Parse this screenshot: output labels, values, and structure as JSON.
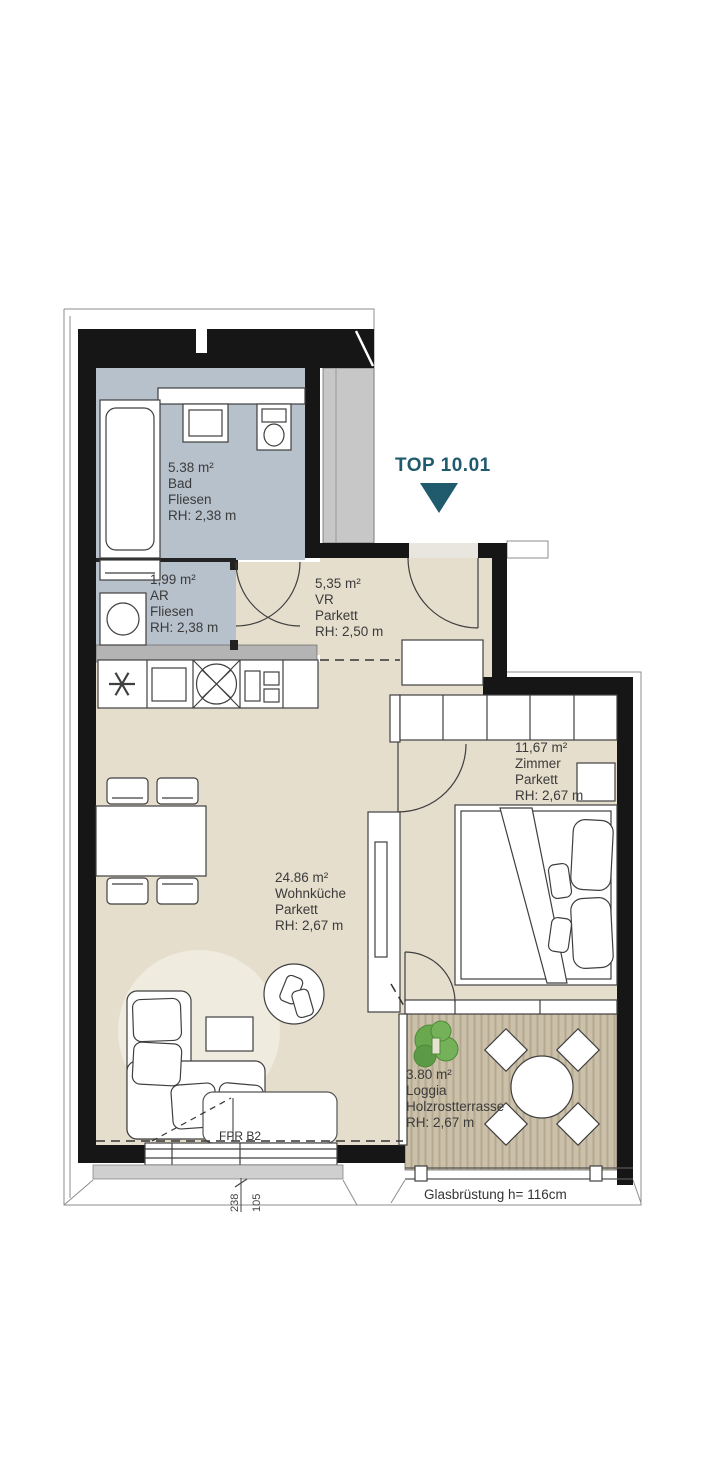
{
  "unit": {
    "label": "TOP 10.01"
  },
  "rooms": [
    {
      "id": "bad",
      "area": "5.38 m²",
      "name": "Bad",
      "floor": "Fliesen",
      "rh": "RH: 2,38 m"
    },
    {
      "id": "ar",
      "area": "1,99 m²",
      "name": "AR",
      "floor": "Fliesen",
      "rh": "RH: 2,38 m"
    },
    {
      "id": "vr",
      "area": "5,35 m²",
      "name": "VR",
      "floor": "Parkett",
      "rh": "RH: 2,50 m"
    },
    {
      "id": "wohnkueche",
      "area": "24.86 m²",
      "name": "Wohnküche",
      "floor": "Parkett",
      "rh": "RH: 2,67 m"
    },
    {
      "id": "zimmer",
      "area": "11,67 m²",
      "name": "Zimmer",
      "floor": "Parkett",
      "rh": "RH: 2,67 m"
    },
    {
      "id": "loggia",
      "area": "3.80 m²",
      "name": "Loggia",
      "floor": "Holzrostterrasse",
      "rh": "RH: 2,67 m"
    }
  ],
  "annotations": {
    "window_note": "FPR B2",
    "balustrade_note": "Glasbrüstung h= 116cm",
    "dimensions": [
      "238",
      "105"
    ]
  },
  "colors": {
    "accent_teal": "#1f5a6d",
    "wall_black": "#161616",
    "wet_room_floor": "#b7c1cc",
    "living_floor": "#e6decd",
    "deck_floor": "#cbc0a9",
    "shaft_gray": "#c7c7c7"
  }
}
